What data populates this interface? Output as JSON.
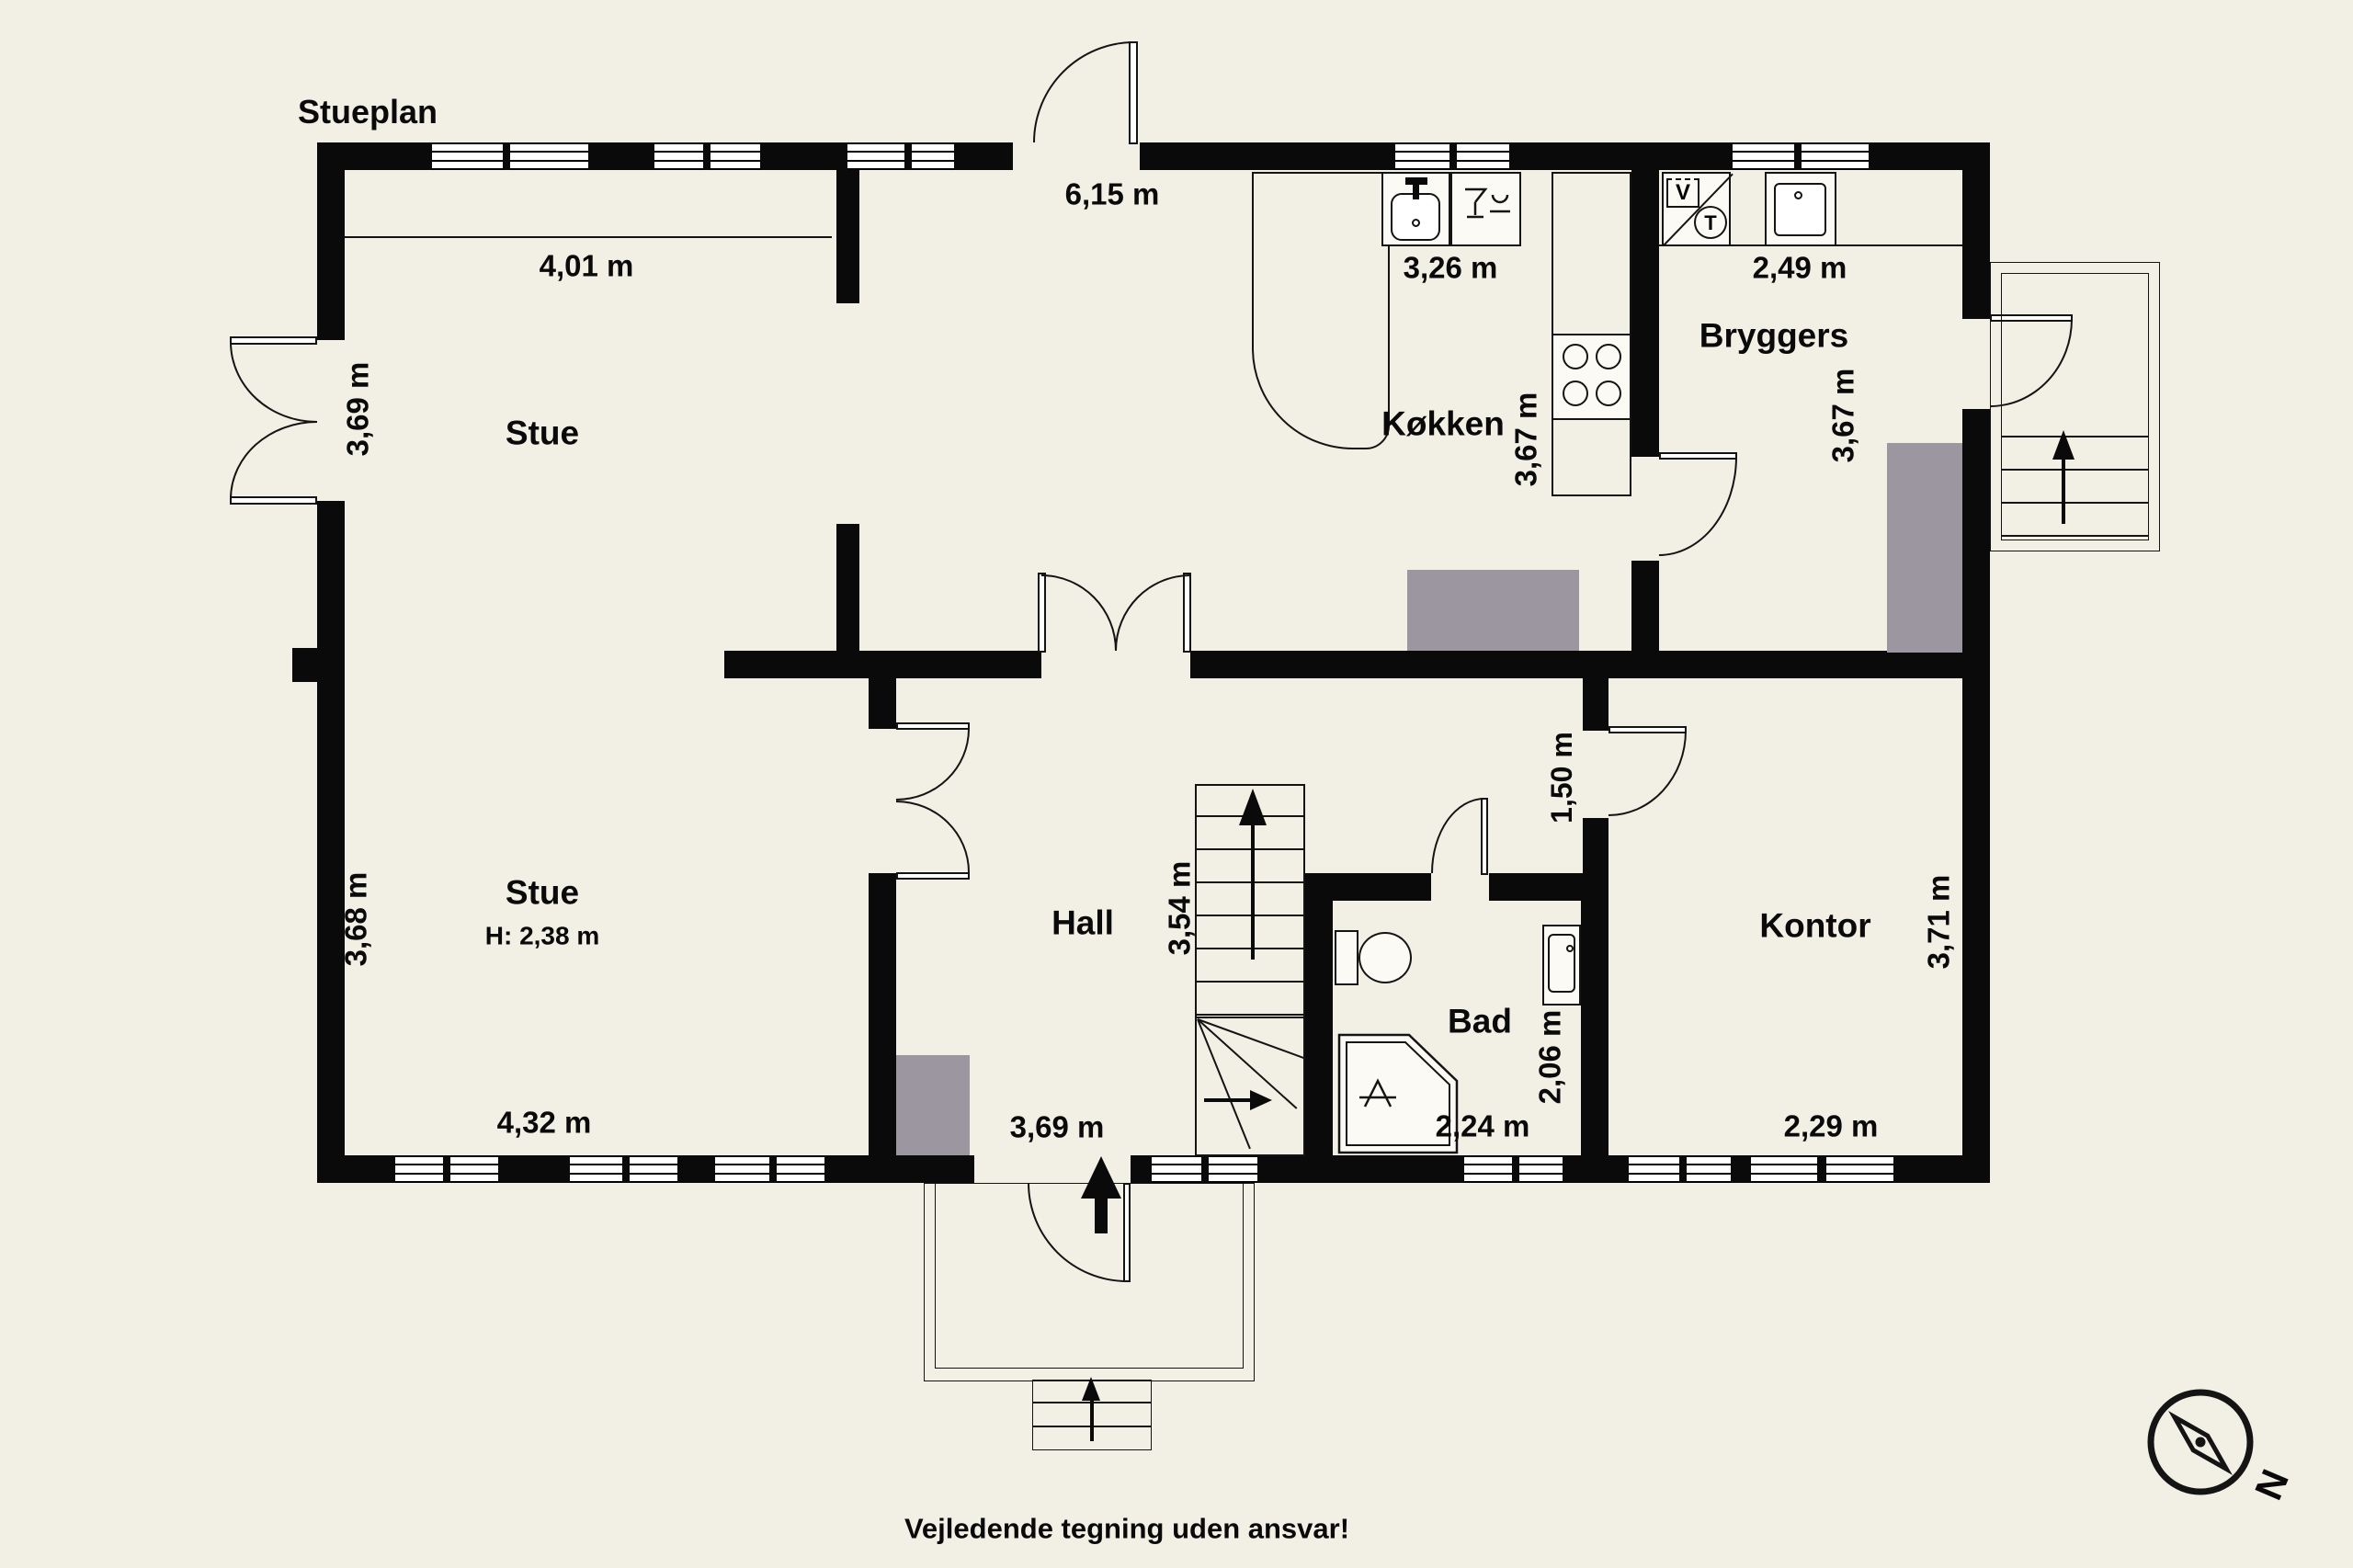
{
  "title": "Stueplan",
  "disclaimer": "Vejledende tegning uden ansvar!",
  "compass": {
    "north": "N"
  },
  "appliances": {
    "washer": "V",
    "dryer": "T"
  },
  "rooms": {
    "stue_upper": {
      "name": "Stue",
      "width": "4,01 m",
      "height": "3,69 m"
    },
    "dining": {
      "width": "6,15 m"
    },
    "kokken": {
      "name": "Køkken",
      "width": "3,26 m",
      "height": "3,67 m"
    },
    "bryggers": {
      "name": "Bryggers",
      "width": "2,49 m",
      "height": "3,67 m"
    },
    "stue_lower": {
      "name": "Stue",
      "ceiling": "H: 2,38 m",
      "width": "4,32 m",
      "height": "3,68 m"
    },
    "hall": {
      "name": "Hall",
      "width": "3,69 m",
      "height": "3,54 m"
    },
    "corridor": {
      "width": "1,50 m"
    },
    "bad": {
      "name": "Bad",
      "width": "2,24 m",
      "height": "2,06 m"
    },
    "kontor": {
      "name": "Kontor",
      "width": "2,29 m",
      "height": "3,71 m"
    }
  },
  "colors": {
    "background": "#f2efe5",
    "wall": "#0a0a0a",
    "chimney": "#9b96a0",
    "line": "#141414"
  }
}
